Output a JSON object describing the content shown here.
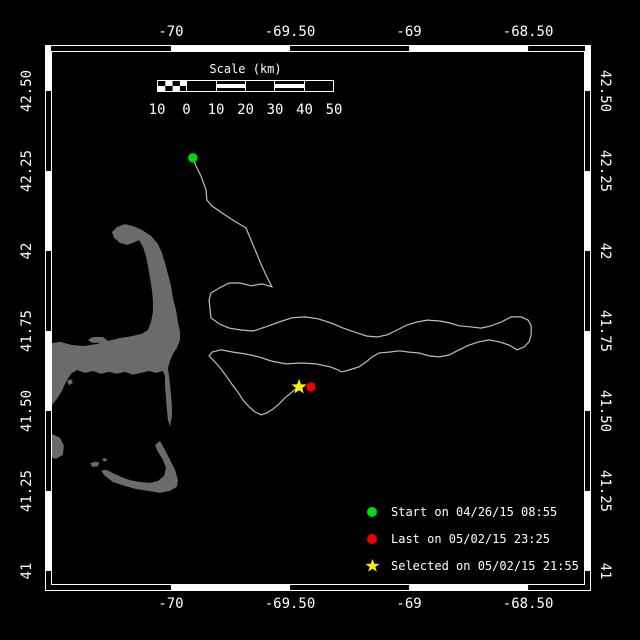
{
  "window": {
    "width_px": 640,
    "height_px": 640,
    "background": "#000000"
  },
  "chart_data": {
    "type": "line",
    "subtype": "geographic track map with land mask",
    "grid": "off",
    "frame": {
      "style": "alternating black/white border bands",
      "color": "#ffffff"
    },
    "colors": {
      "background": "#000000",
      "land": "#6b6b6b",
      "track": "#bdbdbd",
      "text": "#ffffff"
    },
    "x_axis": {
      "unit": "longitude (deg)",
      "ticks": [
        -70,
        -69.5,
        -69,
        -68.5
      ],
      "tick_labels": [
        "-70",
        "-69.50",
        "-69",
        "-68.50"
      ],
      "range": [
        -70.504,
        -68.261
      ]
    },
    "y_axis": {
      "unit": "latitude (deg)",
      "ticks": [
        42.5,
        42.25,
        42.0,
        41.75,
        41.5,
        41.25,
        41.0
      ],
      "tick_labels": [
        "42.50",
        "42.25",
        "42",
        "41.75",
        "41.50",
        "41.25",
        "41"
      ],
      "range": [
        40.956,
        42.625
      ]
    },
    "scale_bar": {
      "title": "Scale (km)",
      "tick_labels": [
        "10",
        "0",
        "10",
        "20",
        "30",
        "40",
        "50"
      ],
      "segment_km": 10
    },
    "legend": {
      "position": "bottom-right",
      "entries": [
        {
          "marker": "circle",
          "color": "#00dd00",
          "label": "Start on 04/26/15 08:55"
        },
        {
          "marker": "circle",
          "color": "#ee0000",
          "label": "Last on 05/02/15 23:25"
        },
        {
          "marker": "star",
          "color": "#ffee00",
          "label": "Selected on 05/02/15 21:55"
        }
      ]
    },
    "markers": [
      {
        "name": "start",
        "shape": "circle",
        "color": "#00dd00",
        "lon": -69.908,
        "lat": 42.291
      },
      {
        "name": "last",
        "shape": "circle",
        "color": "#ee0000",
        "lon": -69.412,
        "lat": 41.575
      },
      {
        "name": "selected",
        "shape": "star",
        "color": "#ffee00",
        "lon": -69.462,
        "lat": 41.575
      }
    ],
    "track_points": [
      [
        -69.908,
        42.291
      ],
      [
        -69.895,
        42.266
      ],
      [
        -69.874,
        42.234
      ],
      [
        -69.853,
        42.191
      ],
      [
        -69.849,
        42.159
      ],
      [
        -69.828,
        42.141
      ],
      [
        -69.786,
        42.119
      ],
      [
        -69.735,
        42.094
      ],
      [
        -69.685,
        42.072
      ],
      [
        -69.664,
        42.034
      ],
      [
        -69.643,
        41.997
      ],
      [
        -69.622,
        41.959
      ],
      [
        -69.597,
        41.919
      ],
      [
        -69.576,
        41.888
      ],
      [
        -69.618,
        41.897
      ],
      [
        -69.664,
        41.891
      ],
      [
        -69.71,
        41.9
      ],
      [
        -69.756,
        41.9
      ],
      [
        -69.798,
        41.884
      ],
      [
        -69.832,
        41.869
      ],
      [
        -69.84,
        41.847
      ],
      [
        -69.836,
        41.819
      ],
      [
        -69.832,
        41.791
      ],
      [
        -69.798,
        41.772
      ],
      [
        -69.756,
        41.759
      ],
      [
        -69.706,
        41.753
      ],
      [
        -69.655,
        41.75
      ],
      [
        -69.601,
        41.763
      ],
      [
        -69.546,
        41.778
      ],
      [
        -69.492,
        41.791
      ],
      [
        -69.437,
        41.794
      ],
      [
        -69.382,
        41.788
      ],
      [
        -69.328,
        41.775
      ],
      [
        -69.277,
        41.759
      ],
      [
        -69.218,
        41.744
      ],
      [
        -69.176,
        41.734
      ],
      [
        -69.134,
        41.731
      ],
      [
        -69.092,
        41.738
      ],
      [
        -69.05,
        41.753
      ],
      [
        -69.008,
        41.769
      ],
      [
        -68.966,
        41.778
      ],
      [
        -68.924,
        41.784
      ],
      [
        -68.87,
        41.781
      ],
      [
        -68.828,
        41.775
      ],
      [
        -68.79,
        41.766
      ],
      [
        -68.744,
        41.763
      ],
      [
        -68.697,
        41.759
      ],
      [
        -68.655,
        41.766
      ],
      [
        -68.613,
        41.778
      ],
      [
        -68.571,
        41.794
      ],
      [
        -68.529,
        41.794
      ],
      [
        -68.5,
        41.784
      ],
      [
        -68.487,
        41.766
      ],
      [
        -68.487,
        41.738
      ],
      [
        -68.496,
        41.716
      ],
      [
        -68.517,
        41.7
      ],
      [
        -68.546,
        41.691
      ],
      [
        -68.58,
        41.706
      ],
      [
        -68.622,
        41.716
      ],
      [
        -68.664,
        41.722
      ],
      [
        -68.706,
        41.716
      ],
      [
        -68.748,
        41.706
      ],
      [
        -68.79,
        41.691
      ],
      [
        -68.832,
        41.675
      ],
      [
        -68.874,
        41.669
      ],
      [
        -68.916,
        41.672
      ],
      [
        -68.958,
        41.681
      ],
      [
        -69.0,
        41.684
      ],
      [
        -69.042,
        41.688
      ],
      [
        -69.084,
        41.684
      ],
      [
        -69.126,
        41.681
      ],
      [
        -69.155,
        41.669
      ],
      [
        -69.181,
        41.653
      ],
      [
        -69.21,
        41.638
      ],
      [
        -69.252,
        41.628
      ],
      [
        -69.282,
        41.622
      ],
      [
        -69.307,
        41.631
      ],
      [
        -69.332,
        41.638
      ],
      [
        -69.391,
        41.647
      ],
      [
        -69.454,
        41.65
      ],
      [
        -69.517,
        41.647
      ],
      [
        -69.58,
        41.656
      ],
      [
        -69.63,
        41.669
      ],
      [
        -69.685,
        41.678
      ],
      [
        -69.739,
        41.684
      ],
      [
        -69.79,
        41.691
      ],
      [
        -69.828,
        41.684
      ],
      [
        -69.84,
        41.672
      ],
      [
        -69.815,
        41.653
      ],
      [
        -69.79,
        41.631
      ],
      [
        -69.765,
        41.606
      ],
      [
        -69.744,
        41.584
      ],
      [
        -69.719,
        41.559
      ],
      [
        -69.697,
        41.534
      ],
      [
        -69.672,
        41.513
      ],
      [
        -69.647,
        41.497
      ],
      [
        -69.622,
        41.488
      ],
      [
        -69.597,
        41.494
      ],
      [
        -69.571,
        41.506
      ],
      [
        -69.546,
        41.522
      ],
      [
        -69.521,
        41.541
      ],
      [
        -69.496,
        41.556
      ],
      [
        -69.471,
        41.572
      ],
      [
        -69.462,
        41.575
      ]
    ],
    "land_polygons": [
      [
        [
          -70.521,
          41.709
        ],
        [
          -70.466,
          41.716
        ],
        [
          -70.416,
          41.706
        ],
        [
          -70.366,
          41.703
        ],
        [
          -70.315,
          41.709
        ],
        [
          -70.265,
          41.719
        ],
        [
          -70.214,
          41.728
        ],
        [
          -70.164,
          41.734
        ],
        [
          -70.122,
          41.741
        ],
        [
          -70.097,
          41.753
        ],
        [
          -70.084,
          41.778
        ],
        [
          -70.076,
          41.809
        ],
        [
          -70.076,
          41.847
        ],
        [
          -70.08,
          41.878
        ],
        [
          -70.088,
          41.916
        ],
        [
          -70.097,
          41.953
        ],
        [
          -70.105,
          41.984
        ],
        [
          -70.118,
          42.013
        ],
        [
          -70.134,
          42.034
        ],
        [
          -70.16,
          42.025
        ],
        [
          -70.185,
          42.019
        ],
        [
          -70.214,
          42.025
        ],
        [
          -70.239,
          42.041
        ],
        [
          -70.248,
          42.059
        ],
        [
          -70.227,
          42.075
        ],
        [
          -70.193,
          42.084
        ],
        [
          -70.16,
          42.078
        ],
        [
          -70.122,
          42.066
        ],
        [
          -70.084,
          42.047
        ],
        [
          -70.055,
          42.022
        ],
        [
          -70.038,
          41.994
        ],
        [
          -70.025,
          41.963
        ],
        [
          -70.013,
          41.928
        ],
        [
          -70.0,
          41.891
        ],
        [
          -69.992,
          41.853
        ],
        [
          -69.979,
          41.816
        ],
        [
          -69.971,
          41.778
        ],
        [
          -69.962,
          41.747
        ],
        [
          -69.962,
          41.722
        ],
        [
          -69.975,
          41.697
        ],
        [
          -69.992,
          41.678
        ],
        [
          -70.004,
          41.656
        ],
        [
          -70.013,
          41.634
        ],
        [
          -70.008,
          41.609
        ],
        [
          -70.004,
          41.581
        ],
        [
          -70.0,
          41.55
        ],
        [
          -69.996,
          41.516
        ],
        [
          -69.996,
          41.484
        ],
        [
          -70.004,
          41.45
        ],
        [
          -70.013,
          41.472
        ],
        [
          -70.017,
          41.503
        ],
        [
          -70.021,
          41.541
        ],
        [
          -70.025,
          41.578
        ],
        [
          -70.025,
          41.609
        ],
        [
          -70.034,
          41.625
        ],
        [
          -70.063,
          41.619
        ],
        [
          -70.092,
          41.625
        ],
        [
          -70.126,
          41.619
        ],
        [
          -70.16,
          41.613
        ],
        [
          -70.193,
          41.622
        ],
        [
          -70.227,
          41.616
        ],
        [
          -70.261,
          41.622
        ],
        [
          -70.294,
          41.616
        ],
        [
          -70.328,
          41.625
        ],
        [
          -70.361,
          41.619
        ],
        [
          -70.395,
          41.628
        ],
        [
          -70.42,
          41.616
        ],
        [
          -70.441,
          41.591
        ],
        [
          -70.458,
          41.563
        ],
        [
          -70.479,
          41.538
        ],
        [
          -70.5,
          41.519
        ],
        [
          -70.521,
          41.506
        ]
      ],
      [
        [
          -70.349,
          41.722
        ],
        [
          -70.328,
          41.731
        ],
        [
          -70.286,
          41.731
        ],
        [
          -70.265,
          41.719
        ],
        [
          -70.29,
          41.713
        ],
        [
          -70.332,
          41.713
        ]
      ],
      [
        [
          -70.046,
          41.406
        ],
        [
          -70.025,
          41.378
        ],
        [
          -70.004,
          41.347
        ],
        [
          -69.983,
          41.316
        ],
        [
          -69.971,
          41.284
        ],
        [
          -69.975,
          41.263
        ],
        [
          -70.004,
          41.25
        ],
        [
          -70.046,
          41.244
        ],
        [
          -70.097,
          41.25
        ],
        [
          -70.147,
          41.256
        ],
        [
          -70.197,
          41.266
        ],
        [
          -70.244,
          41.278
        ],
        [
          -70.277,
          41.297
        ],
        [
          -70.294,
          41.313
        ],
        [
          -70.273,
          41.316
        ],
        [
          -70.244,
          41.306
        ],
        [
          -70.21,
          41.294
        ],
        [
          -70.172,
          41.284
        ],
        [
          -70.13,
          41.278
        ],
        [
          -70.088,
          41.275
        ],
        [
          -70.055,
          41.281
        ],
        [
          -70.029,
          41.297
        ],
        [
          -70.021,
          41.322
        ],
        [
          -70.034,
          41.347
        ],
        [
          -70.055,
          41.372
        ],
        [
          -70.067,
          41.394
        ]
      ],
      [
        [
          -70.5,
          41.428
        ],
        [
          -70.466,
          41.416
        ],
        [
          -70.45,
          41.391
        ],
        [
          -70.454,
          41.363
        ],
        [
          -70.483,
          41.35
        ],
        [
          -70.508,
          41.356
        ],
        [
          -70.517,
          41.378
        ],
        [
          -70.513,
          41.409
        ]
      ],
      [
        [
          -70.34,
          41.336
        ],
        [
          -70.318,
          41.341
        ],
        [
          -70.301,
          41.338
        ],
        [
          -70.307,
          41.327
        ],
        [
          -70.33,
          41.325
        ]
      ],
      [
        [
          -70.29,
          41.35
        ],
        [
          -70.275,
          41.353
        ],
        [
          -70.267,
          41.346
        ],
        [
          -70.281,
          41.341
        ]
      ],
      [
        [
          -70.437,
          41.594
        ],
        [
          -70.42,
          41.6
        ],
        [
          -70.412,
          41.588
        ],
        [
          -70.428,
          41.58
        ]
      ]
    ]
  }
}
